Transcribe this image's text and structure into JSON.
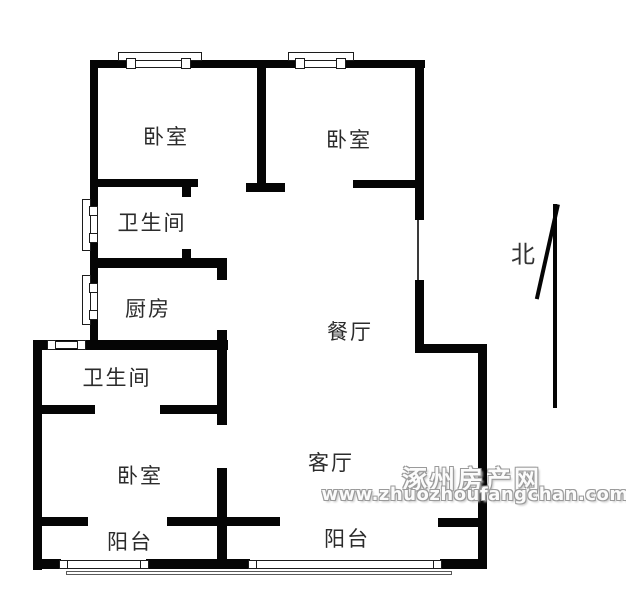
{
  "page": {
    "background_color": "#ffffff",
    "wall_color": "#050505",
    "label_color": "#2b2b2b",
    "watermark_fill": "#fbfbfb",
    "watermark_outline": "#9a9a9a"
  },
  "rooms": [
    {
      "id": "bedroom-top-left",
      "label": "卧室",
      "x": 166,
      "y": 136
    },
    {
      "id": "bedroom-top-right",
      "label": "卧室",
      "x": 349,
      "y": 139
    },
    {
      "id": "bathroom-upper",
      "label": "卫生间",
      "x": 152,
      "y": 222
    },
    {
      "id": "kitchen",
      "label": "厨房",
      "x": 148,
      "y": 308
    },
    {
      "id": "dining-room",
      "label": "餐厅",
      "x": 350,
      "y": 331
    },
    {
      "id": "bathroom-lower",
      "label": "卫生间",
      "x": 117,
      "y": 377
    },
    {
      "id": "bedroom-bottom",
      "label": "卧室",
      "x": 140,
      "y": 475
    },
    {
      "id": "living-room",
      "label": "客厅",
      "x": 331,
      "y": 462
    },
    {
      "id": "balcony-left",
      "label": "阳台",
      "x": 130,
      "y": 541
    },
    {
      "id": "balcony-right",
      "label": "阳台",
      "x": 347,
      "y": 538
    }
  ],
  "north": {
    "label": "北"
  },
  "watermark": {
    "title": "涿州房产网",
    "url": "www.zhuozhoufangchan.com"
  },
  "floorplan": {
    "walls": [
      [
        92,
        60,
        333,
        8
      ],
      [
        90,
        60,
        8,
        285
      ],
      [
        33,
        340,
        195,
        10
      ],
      [
        33,
        340,
        9,
        230
      ],
      [
        415,
        60,
        9,
        160
      ],
      [
        415,
        280,
        9,
        73
      ],
      [
        415,
        344,
        72,
        9
      ],
      [
        478,
        344,
        9,
        225
      ],
      [
        257,
        60,
        9,
        124
      ],
      [
        246,
        183,
        39,
        9
      ],
      [
        92,
        179,
        106,
        8
      ],
      [
        182,
        187,
        9,
        10
      ],
      [
        353,
        180,
        69,
        8
      ],
      [
        98,
        258,
        129,
        10
      ],
      [
        182,
        249,
        9,
        9
      ],
      [
        217,
        268,
        10,
        12
      ],
      [
        217,
        330,
        10,
        11
      ],
      [
        217,
        340,
        10,
        85
      ],
      [
        33,
        405,
        62,
        9
      ],
      [
        160,
        405,
        67,
        9
      ],
      [
        217,
        468,
        10,
        101
      ],
      [
        33,
        517,
        55,
        9
      ],
      [
        167,
        517,
        113,
        9
      ],
      [
        438,
        518,
        40,
        9
      ],
      [
        33,
        559,
        28,
        10
      ],
      [
        146,
        559,
        104,
        10
      ],
      [
        440,
        559,
        47,
        10
      ]
    ],
    "windows": [
      {
        "name": "bedroom1-window",
        "outer": [
          118,
          52,
          84,
          9
        ],
        "band": [
          135,
          60,
          48,
          8
        ],
        "caps": [
          [
            126,
            58,
            10,
            11
          ],
          [
            181,
            58,
            10,
            11
          ]
        ]
      },
      {
        "name": "bedroom2-window",
        "outer": [
          288,
          52,
          66,
          9
        ],
        "band": [
          304,
          60,
          34,
          8
        ],
        "caps": [
          [
            295,
            58,
            10,
            11
          ],
          [
            336,
            58,
            10,
            11
          ]
        ]
      },
      {
        "name": "bathroom-upper-window",
        "outer": [
          82,
          199,
          9,
          52
        ],
        "band": [
          90,
          209,
          8,
          34
        ],
        "caps": [
          [
            89,
            206,
            9,
            10
          ],
          [
            89,
            233,
            9,
            10
          ]
        ]
      },
      {
        "name": "kitchen-window",
        "outer": [
          82,
          275,
          9,
          50
        ],
        "band": [
          90,
          286,
          8,
          32
        ],
        "caps": [
          [
            89,
            283,
            9,
            10
          ],
          [
            89,
            310,
            9,
            10
          ]
        ]
      },
      {
        "name": "bathroom-lower-window",
        "band": [
          48,
          341,
          38,
          8
        ],
        "caps": [
          [
            47,
            340,
            9,
            10
          ],
          [
            77,
            340,
            9,
            10
          ]
        ]
      },
      {
        "name": "balcony-left-window",
        "band": [
          59,
          560,
          90,
          9
        ],
        "caps": [
          [
            59,
            560,
            9,
            9
          ],
          [
            140,
            560,
            9,
            9
          ]
        ]
      },
      {
        "name": "balcony-right-window",
        "band": [
          248,
          560,
          194,
          9
        ],
        "caps": [
          [
            248,
            560,
            9,
            9
          ],
          [
            433,
            560,
            9,
            9
          ]
        ]
      }
    ],
    "door_lines": [
      [
        417,
        220,
        2,
        60
      ]
    ],
    "outline_lines": [
      [
        66,
        571,
        386,
        4
      ]
    ],
    "north_arrow": {
      "shaft": [
        553,
        204,
        4,
        204
      ],
      "head": {
        "rect": [
          556,
          204,
          4,
          97
        ],
        "rotate": 12.6
      }
    }
  }
}
